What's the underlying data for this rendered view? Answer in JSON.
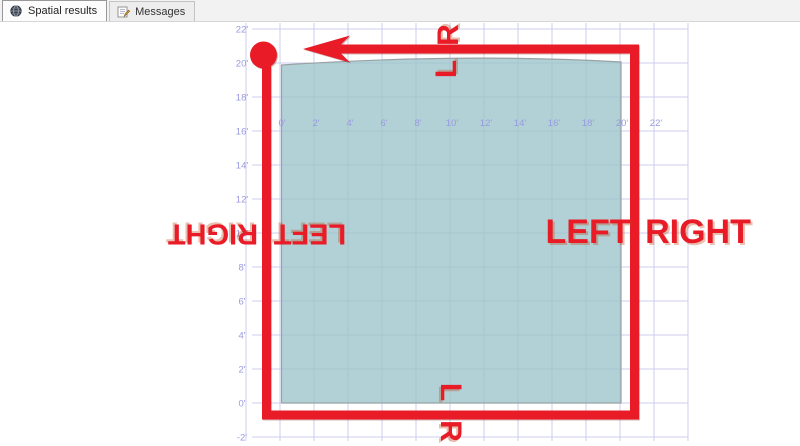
{
  "tab_bar": {
    "tabs": [
      {
        "label": "Spatial results",
        "icon": "globe-icon",
        "active": true
      },
      {
        "label": "Messages",
        "icon": "messages-icon",
        "active": false
      }
    ]
  },
  "chart": {
    "x_tick_labels": [
      "0'",
      "2'",
      "4'",
      "6'",
      "8'",
      "10'",
      "12'",
      "14'",
      "16'",
      "18'",
      "20'",
      "22'"
    ],
    "y_tick_labels": [
      "22'",
      "20'",
      "18'",
      "16'",
      "14'",
      "12'",
      "10'",
      "8'",
      "6'",
      "4'",
      "2'",
      "0'",
      "-2'"
    ],
    "grid_color": "#ccccee",
    "tick_label_color": "#9a9ae0",
    "shape_fill": "#9cc4cb",
    "shape_outline": "#98a2a4",
    "shape_extent": {
      "x_min": "0'",
      "x_max": "20'",
      "y_min": "0'",
      "y_max": "20'"
    }
  },
  "annotations": {
    "color": "#e81b27",
    "start_marker": "filled-circle",
    "direction_arrow": "left",
    "top_outside_label": "R",
    "top_inside_label": "L",
    "left_outside_label": "RIGHT",
    "left_inside_label": "LEFT",
    "right_inside_label": "LEFT",
    "right_outside_label": "RIGHT",
    "bottom_inside_label": "L",
    "bottom_outside_label": "R"
  }
}
